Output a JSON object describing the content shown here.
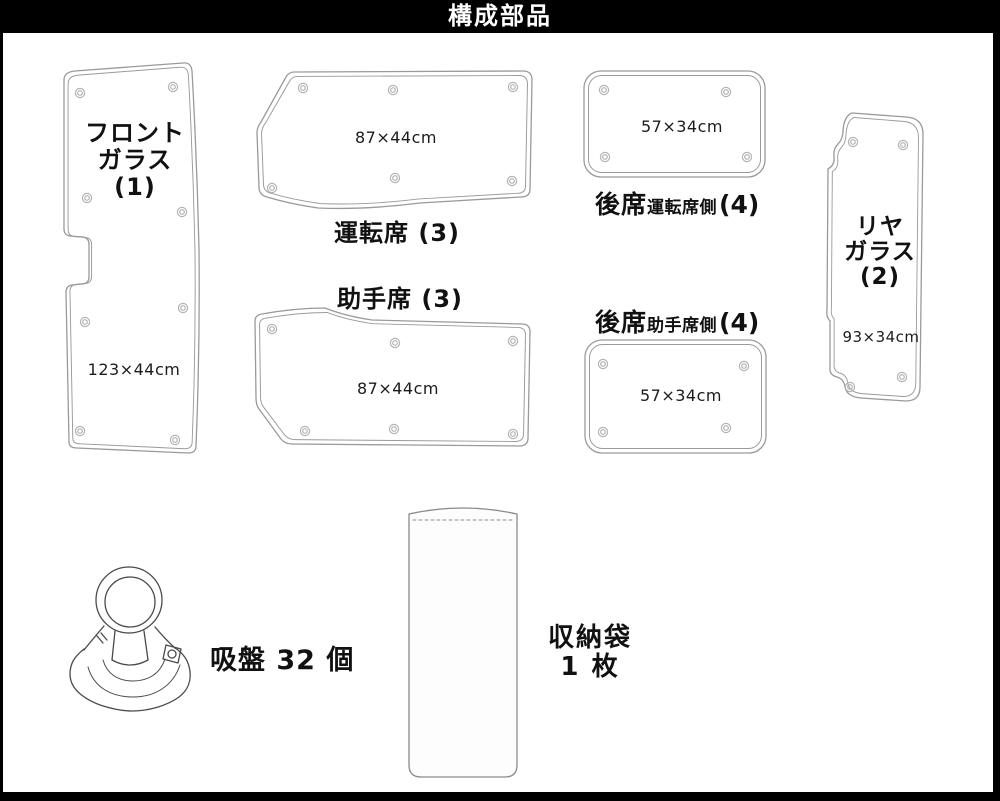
{
  "header": {
    "title": "構成部品"
  },
  "colors": {
    "header_bg": "#000000",
    "header_text": "#ffffff",
    "mat_outline": "#9a9a9a",
    "illustration_line": "#4a4a4a",
    "label_text": "#111111"
  },
  "components": {
    "front_glass": {
      "name_line1": "フロント",
      "name_line2": "ガラス",
      "name_line3": "(1)",
      "size": "123×44cm"
    },
    "driver_seat": {
      "label": "運転席 (3)",
      "size": "87×44cm"
    },
    "passenger_seat": {
      "label": "助手席 (3)",
      "size": "87×44cm"
    },
    "rear_seat_driver": {
      "label_main": "後席",
      "label_sub": "運転席側",
      "label_count": "(4)",
      "size": "57×34cm"
    },
    "rear_seat_passenger": {
      "label_main": "後席",
      "label_sub": "助手席側",
      "label_count": "(4)",
      "size": "57×34cm"
    },
    "rear_glass": {
      "name_line1": "リヤ",
      "name_line2": "ガラス",
      "name_line3": "(2)",
      "size": "93×34cm"
    },
    "suction_cup": {
      "label": "吸盤 32 個"
    },
    "storage_bag": {
      "label_line1": "収納袋",
      "label_line2": "1 枚"
    }
  }
}
